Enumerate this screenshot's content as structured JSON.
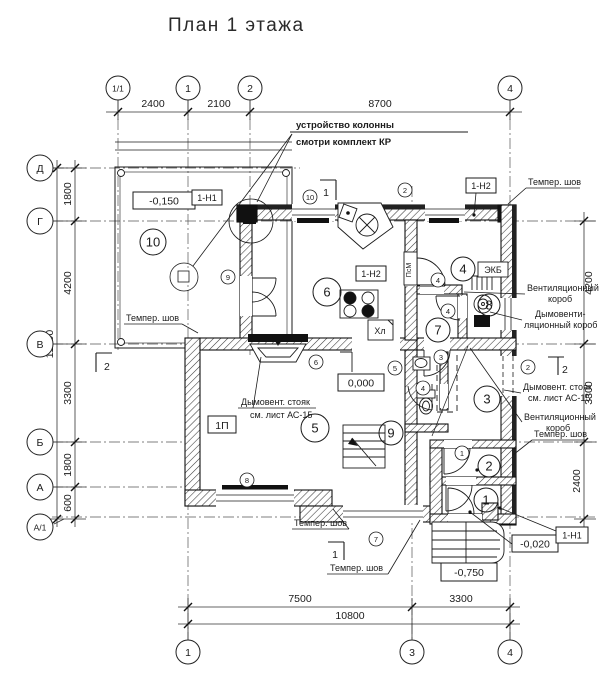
{
  "title": "План 1 этажа",
  "axes_top": [
    "1/1",
    "1",
    "2",
    "4"
  ],
  "axes_bottom": [
    "1",
    "3",
    "4"
  ],
  "axes_left": [
    "Д",
    "Г",
    "В",
    "Б",
    "А",
    "А/1"
  ],
  "dims": {
    "top": [
      "2400",
      "2100",
      "8700"
    ],
    "left": [
      "1800",
      "4200",
      "3300",
      "1800",
      "600"
    ],
    "left_total": "11700",
    "right": [
      "4200",
      "3300",
      "2400"
    ],
    "bottom": [
      "7500",
      "3300"
    ],
    "bottom_total": "10800"
  },
  "notes": {
    "column_l1": "устройство колонны",
    "column_l2": "смотри комплект КР",
    "flue_l1": "Дымовент. стояк",
    "flue_l2": "см. лист АС-15",
    "vent_l1": "Вентиляционный",
    "vent_l2": "короб",
    "smoke_l1": "Дымовенти-",
    "smoke_l2": "ляционный короб",
    "seam": "Темпер. шов"
  },
  "levels": {
    "terrace": "-0,150",
    "ground": "0,000",
    "entry": "-0,020",
    "porch": "-0,750"
  },
  "tags": {
    "n1": "1-Н1",
    "n2": "1-Н2",
    "p1": "1П",
    "ekb": "ЭКБ",
    "fridge": "Хл",
    "sink_unit": "ПсМ"
  },
  "rooms": [
    "10",
    "6",
    "4",
    "8",
    "7",
    "3",
    "5",
    "9",
    "2",
    "1"
  ],
  "openings": [
    "10",
    "2",
    "9",
    "4",
    "4",
    "3",
    "4",
    "6",
    "5",
    "2",
    "8",
    "7",
    "1"
  ],
  "sections": {
    "s1": "1",
    "s2": "2"
  },
  "colors": {
    "ink": "#1b1b1b",
    "paper": "#ffffff"
  }
}
